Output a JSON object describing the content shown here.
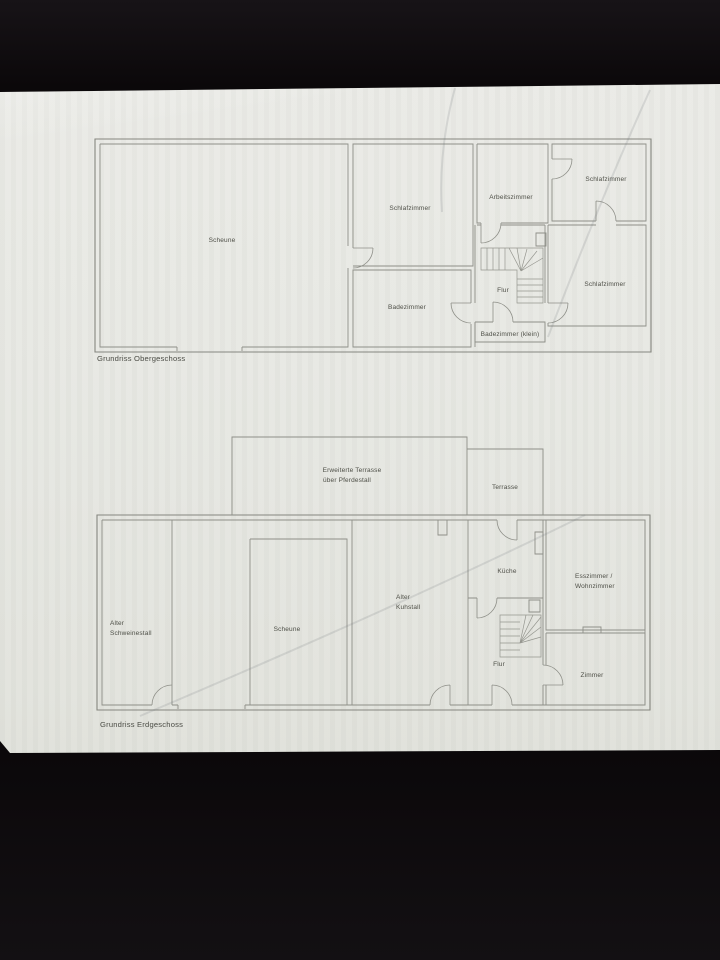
{
  "colors": {
    "background": "#0b080a",
    "paper": "#e7e8e3",
    "wall_line": "#85867f",
    "label_text": "#4e4f47"
  },
  "upper_plan": {
    "caption": "Grundriss Obergeschoss",
    "rooms": {
      "scheune": "Scheune",
      "schlafzimmer_left": "Schlafzimmer",
      "arbeitszimmer": "Arbeitszimmer",
      "schlafzimmer_top_right": "Schlafzimmer",
      "schlafzimmer_bottom_right": "Schlafzimmer",
      "badezimmer": "Badezimmer",
      "badezimmer_klein": "Badezimmer (klein)",
      "flur": "Flur"
    }
  },
  "lower_plan": {
    "caption": "Grundriss Erdgeschoss",
    "rooms": {
      "erweiterte_terrasse_1": "Erweiterte Terrasse",
      "erweiterte_terrasse_2": "über Pferdestall",
      "terrasse": "Terrasse",
      "alter_schweinestall_1": "Alter",
      "alter_schweinestall_2": "Schweinestall",
      "scheune": "Scheune",
      "alter_kuhstall_1": "Alter",
      "alter_kuhstall_2": "Kuhstall",
      "kueche": "Küche",
      "flur": "Flur",
      "esszimmer_1": "Esszimmer /",
      "esszimmer_2": "Wohnzimmer",
      "zimmer": "Zimmer"
    }
  }
}
